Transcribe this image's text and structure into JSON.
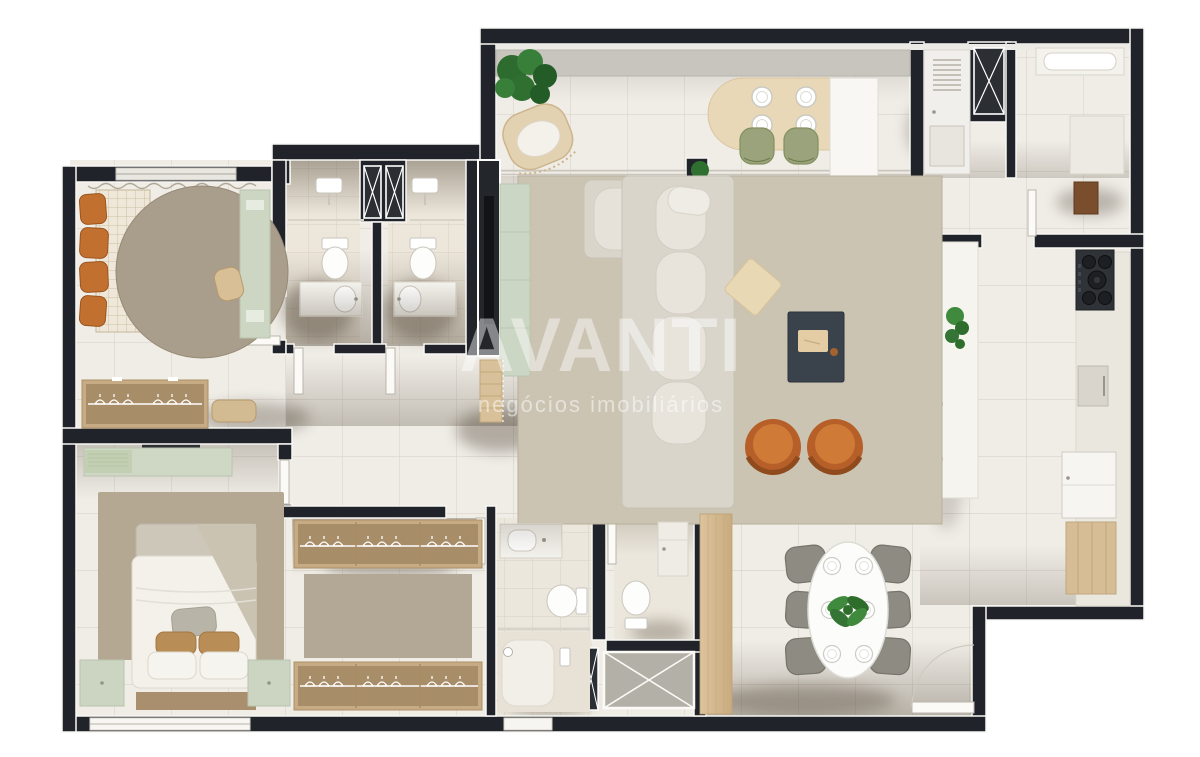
{
  "watermark": {
    "title": "AVANTI",
    "subtitle": "negócios imobiliários"
  },
  "palette": {
    "wall": "#202329",
    "wall_trim": "#f8f7f3",
    "floor": "#f0ede7",
    "tile_line": "#ddd8cf",
    "bath_floor": "#ece6db",
    "rug_living": "#cbc4b2",
    "rug_round": "#a99d8b",
    "rug_bedroom": "#b5a892",
    "wood_wardrobe": "#c7ab84",
    "wood_entry": "#d6bd96",
    "accent_orange": "#c0682e",
    "accent_green_furniture": "#ccd6c3",
    "terrace_chair_green": "#9aa37b",
    "plant_green": "#347434",
    "dark_coffee_table": "#3a424c",
    "counter_white": "#f6f4ef",
    "stove_dark": "#2f3237",
    "shaft_gray": "#b3b0a7"
  },
  "plan": {
    "type": "apartment-floor-plan",
    "style": "top-down 3D rendered floor plan, no text labels except watermark",
    "rooms": [
      {
        "name": "bedroom-top-left",
        "furniture": [
          "single bed with checkered blanket and orange cushions",
          "round rug",
          "green desk with chair",
          "wardrobe with hangers",
          "bench",
          "window with curtain"
        ]
      },
      {
        "name": "bathroom-1",
        "furniture": [
          "shower head",
          "toilet",
          "vanity sink",
          "door"
        ]
      },
      {
        "name": "bathroom-2",
        "furniture": [
          "shower head",
          "toilet",
          "vanity sink",
          "door"
        ]
      },
      {
        "name": "ventilation-shafts",
        "furniture": [
          "two X-marked shafts between bathrooms",
          "X-marked shaft in service area",
          "two X-marked shafts near entry"
        ]
      },
      {
        "name": "balcony-terrace",
        "furniture": [
          "planter hedge",
          "green shrub",
          "hanging wicker chair",
          "bar counter with four place settings",
          "two green bar chairs",
          "white pillar",
          "glass sliding doors",
          "column with climbing plant"
        ]
      },
      {
        "name": "living-room",
        "furniture": [
          "large area rug",
          "L-shaped sofa",
          "rotated wood side table",
          "dark coffee table with notebook",
          "two round orange armchairs",
          "TV feature panel",
          "green sideboard",
          "decorative wood ladder"
        ]
      },
      {
        "name": "kitchen",
        "furniture": [
          "white island with plant",
          "two gray stools",
          "five-burner cooktop",
          "built-in cabinet",
          "refrigerator",
          "wood pantry cabinet",
          "counter along wall"
        ]
      },
      {
        "name": "laundry-service",
        "furniture": [
          "tall washer unit with vent grid",
          "utility sink counter",
          "side counter",
          "brown water heater",
          "service door"
        ]
      },
      {
        "name": "dining-area",
        "furniture": [
          "oval white table",
          "six gray chairs",
          "six place settings",
          "plant centerpiece",
          "entrance door with swing"
        ]
      },
      {
        "name": "entry-hall",
        "furniture": [
          "wood plank floor strip"
        ]
      },
      {
        "name": "master-bedroom",
        "furniture": [
          "double bed with throw and pillows",
          "two green nightstands",
          "green desk with chair",
          "large rug",
          "window in bottom wall"
        ]
      },
      {
        "name": "walk-in-closet",
        "furniture": [
          "hanger wardrobe top",
          "hanger wardrobe bottom",
          "rug",
          "door"
        ]
      },
      {
        "name": "master-bathroom",
        "furniture": [
          "vanity sink",
          "toilet",
          "glass shower area",
          "small window"
        ]
      },
      {
        "name": "lavatory",
        "furniture": [
          "toilet",
          "tall cabinet",
          "door"
        ]
      }
    ]
  }
}
